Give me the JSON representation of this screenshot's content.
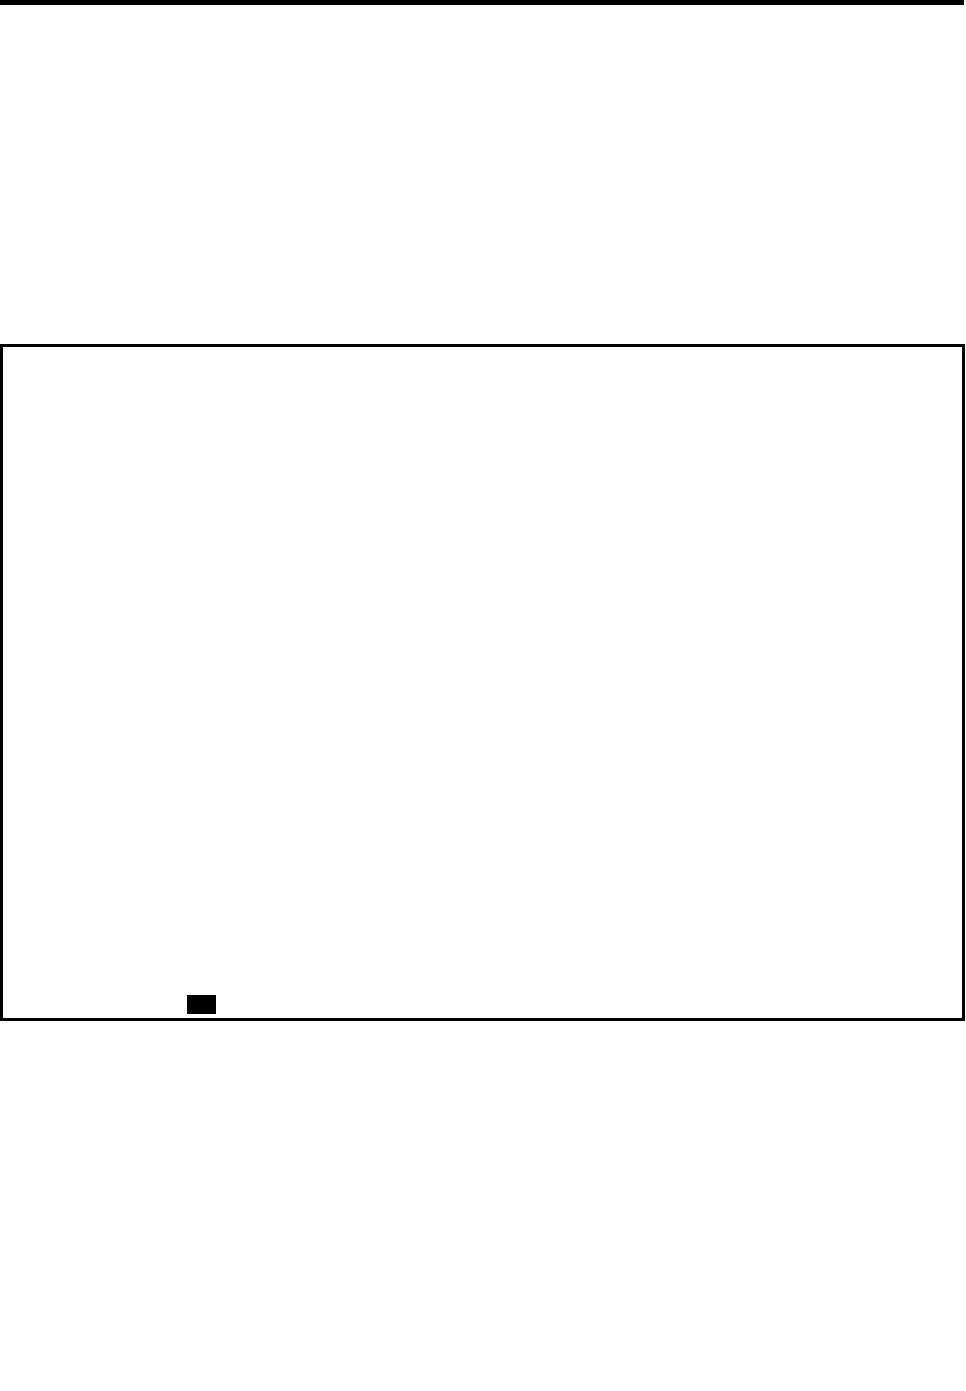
{
  "page": {
    "background_color": "#ffffff",
    "text_content": ""
  },
  "top_rule": {
    "color": "#000000"
  },
  "content_frame": {
    "border_color": "#000000",
    "fill_color": "#ffffff",
    "content": ""
  },
  "black_marker": {
    "color": "#000000"
  }
}
